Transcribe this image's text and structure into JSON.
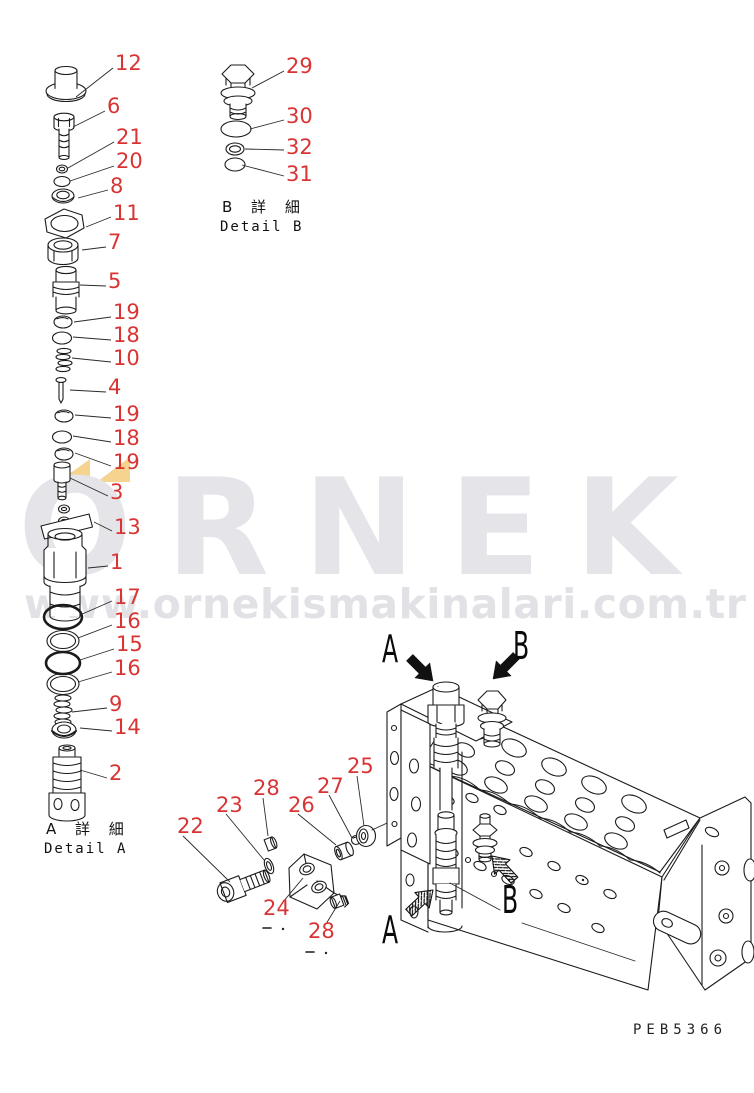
{
  "colors": {
    "callout_red": "#d93434",
    "line": "#1b1b1b",
    "watermark_gray": "#e4e4e9",
    "watermark_url_gray": "#e1e1e6",
    "watermark_yellow": "#f4d48f"
  },
  "watermark": {
    "brand": "ORNEK",
    "url": "www.ornekismakinalari.com.tr"
  },
  "drawing_code": "PEB5366",
  "details": {
    "a_jp": "A 詳 細",
    "a_en": "Detail A",
    "b_jp": "B 詳 細",
    "b_en": "Detail B"
  },
  "view_labels": {
    "top_a": "A",
    "top_b": "B",
    "bottom_a": "A",
    "bottom_b": "B"
  },
  "callouts": [
    {
      "n": "12",
      "x": 115,
      "y": 53,
      "line": [
        113,
        68,
        76,
        97
      ]
    },
    {
      "n": "6",
      "x": 107,
      "y": 96,
      "line": [
        105,
        111,
        73,
        127
      ]
    },
    {
      "n": "21",
      "x": 116,
      "y": 127,
      "line": [
        114,
        142,
        68,
        168
      ]
    },
    {
      "n": "20",
      "x": 116,
      "y": 151,
      "line": [
        114,
        166,
        70,
        181
      ]
    },
    {
      "n": "8",
      "x": 110,
      "y": 176,
      "line": [
        108,
        190,
        78,
        198
      ]
    },
    {
      "n": "11",
      "x": 113,
      "y": 203,
      "line": [
        111,
        217,
        86,
        227
      ]
    },
    {
      "n": "7",
      "x": 108,
      "y": 232,
      "line": [
        106,
        247,
        82,
        250
      ]
    },
    {
      "n": "5",
      "x": 108,
      "y": 271,
      "line": [
        106,
        286,
        80,
        285
      ]
    },
    {
      "n": "19",
      "x": 113,
      "y": 302,
      "line": [
        111,
        317,
        74,
        322
      ]
    },
    {
      "n": "18",
      "x": 113,
      "y": 325,
      "line": [
        111,
        340,
        73,
        337
      ]
    },
    {
      "n": "10",
      "x": 113,
      "y": 348,
      "line": [
        111,
        362,
        72,
        358
      ]
    },
    {
      "n": "4",
      "x": 108,
      "y": 377,
      "line": [
        106,
        392,
        70,
        390
      ]
    },
    {
      "n": "19",
      "x": 113,
      "y": 404,
      "line": [
        111,
        418,
        75,
        415
      ]
    },
    {
      "n": "18",
      "x": 113,
      "y": 428,
      "line": [
        111,
        442,
        73,
        436
      ]
    },
    {
      "n": "19",
      "x": 113,
      "y": 452,
      "line": [
        111,
        466,
        75,
        453
      ]
    },
    {
      "n": "3",
      "x": 110,
      "y": 482,
      "line": [
        108,
        496,
        70,
        478
      ]
    },
    {
      "n": "13",
      "x": 114,
      "y": 517,
      "line": [
        112,
        531,
        94,
        522
      ]
    },
    {
      "n": "1",
      "x": 110,
      "y": 552,
      "line": [
        108,
        566,
        88,
        568
      ]
    },
    {
      "n": "17",
      "x": 114,
      "y": 587,
      "line": [
        112,
        601,
        80,
        615
      ]
    },
    {
      "n": "16",
      "x": 114,
      "y": 611,
      "line": [
        112,
        625,
        78,
        638
      ]
    },
    {
      "n": "15",
      "x": 116,
      "y": 634,
      "line": [
        114,
        649,
        80,
        660
      ]
    },
    {
      "n": "16",
      "x": 114,
      "y": 658,
      "line": [
        112,
        672,
        78,
        682
      ]
    },
    {
      "n": "9",
      "x": 109,
      "y": 694,
      "line": [
        107,
        708,
        72,
        712
      ]
    },
    {
      "n": "14",
      "x": 114,
      "y": 717,
      "line": [
        112,
        731,
        80,
        728
      ]
    },
    {
      "n": "2",
      "x": 109,
      "y": 763,
      "line": [
        107,
        778,
        80,
        770
      ]
    },
    {
      "n": "29",
      "x": 286,
      "y": 56,
      "line": [
        284,
        71,
        252,
        88
      ]
    },
    {
      "n": "30",
      "x": 286,
      "y": 106,
      "line": [
        284,
        120,
        250,
        129
      ]
    },
    {
      "n": "32",
      "x": 286,
      "y": 137,
      "line": [
        284,
        150,
        245,
        149
      ]
    },
    {
      "n": "31",
      "x": 286,
      "y": 164,
      "line": [
        284,
        176,
        242,
        165
      ]
    },
    {
      "n": "22",
      "x": 177,
      "y": 816,
      "line": [
        183,
        836,
        230,
        882
      ]
    },
    {
      "n": "23",
      "x": 216,
      "y": 795,
      "line": [
        226,
        814,
        264,
        860
      ]
    },
    {
      "n": "28",
      "x": 253,
      "y": 778,
      "line": [
        263,
        798,
        268,
        836
      ]
    },
    {
      "n": "26",
      "x": 288,
      "y": 795,
      "line": [
        298,
        814,
        336,
        845
      ]
    },
    {
      "n": "27",
      "x": 317,
      "y": 776,
      "line": [
        329,
        795,
        352,
        838
      ]
    },
    {
      "n": "25",
      "x": 347,
      "y": 756,
      "line": [
        357,
        776,
        364,
        826
      ]
    },
    {
      "n": "24",
      "x": 263,
      "y": 898,
      "line": [
        283,
        902,
        303,
        878
      ]
    },
    {
      "n": "28",
      "x": 308,
      "y": 921,
      "line": [
        326,
        924,
        340,
        901
      ]
    }
  ]
}
